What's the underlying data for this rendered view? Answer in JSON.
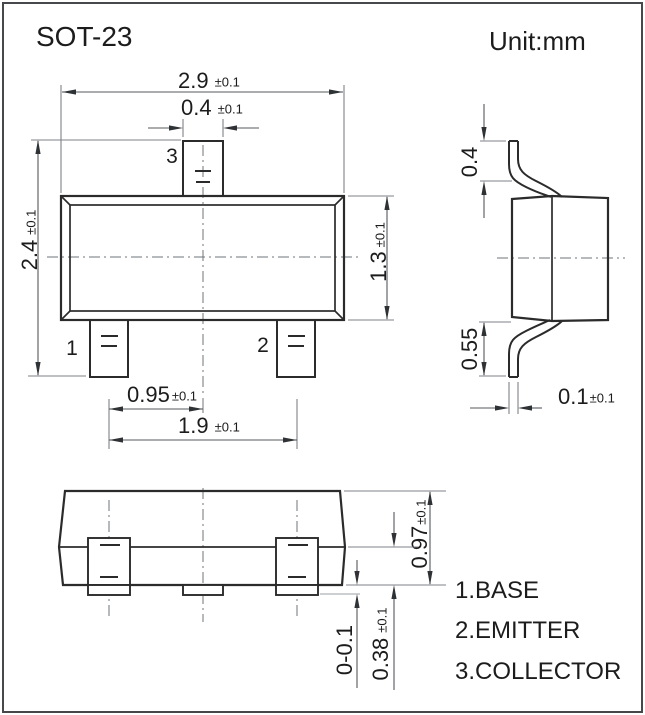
{
  "page": {
    "title": "SOT-23",
    "unit_label": "Unit:mm"
  },
  "top_view": {
    "pins": {
      "p1": "1",
      "p2": "2",
      "p3": "3"
    },
    "dims": {
      "body_width": {
        "value": "2.9",
        "tol": "±0.1"
      },
      "pin_width": {
        "value": "0.4",
        "tol": "±0.1"
      },
      "overall_height": {
        "value": "2.4",
        "tol": "±0.1"
      },
      "body_height": {
        "value": "1.3",
        "tol": "±0.1"
      },
      "pin_pitch": {
        "value": "0.95",
        "tol": "±0.1"
      },
      "pin_span": {
        "value": "1.9",
        "tol": "±0.1"
      }
    }
  },
  "side_view": {
    "dims": {
      "lead_top": {
        "value": "0.4"
      },
      "lead_bottom": {
        "value": "0.55"
      },
      "lead_thickness": {
        "value": "0.1",
        "tol": "±0.1"
      }
    }
  },
  "front_view": {
    "dims": {
      "body_thickness": {
        "value": "0.97",
        "tol": "±0.1"
      },
      "lead_height": {
        "value": "0.38",
        "tol": "±0.1"
      },
      "standoff": {
        "value": "0-0.1"
      }
    }
  },
  "legend": {
    "items": [
      {
        "label": "1.BASE"
      },
      {
        "label": "2.EMITTER"
      },
      {
        "label": "3.COLLECTOR"
      }
    ]
  }
}
